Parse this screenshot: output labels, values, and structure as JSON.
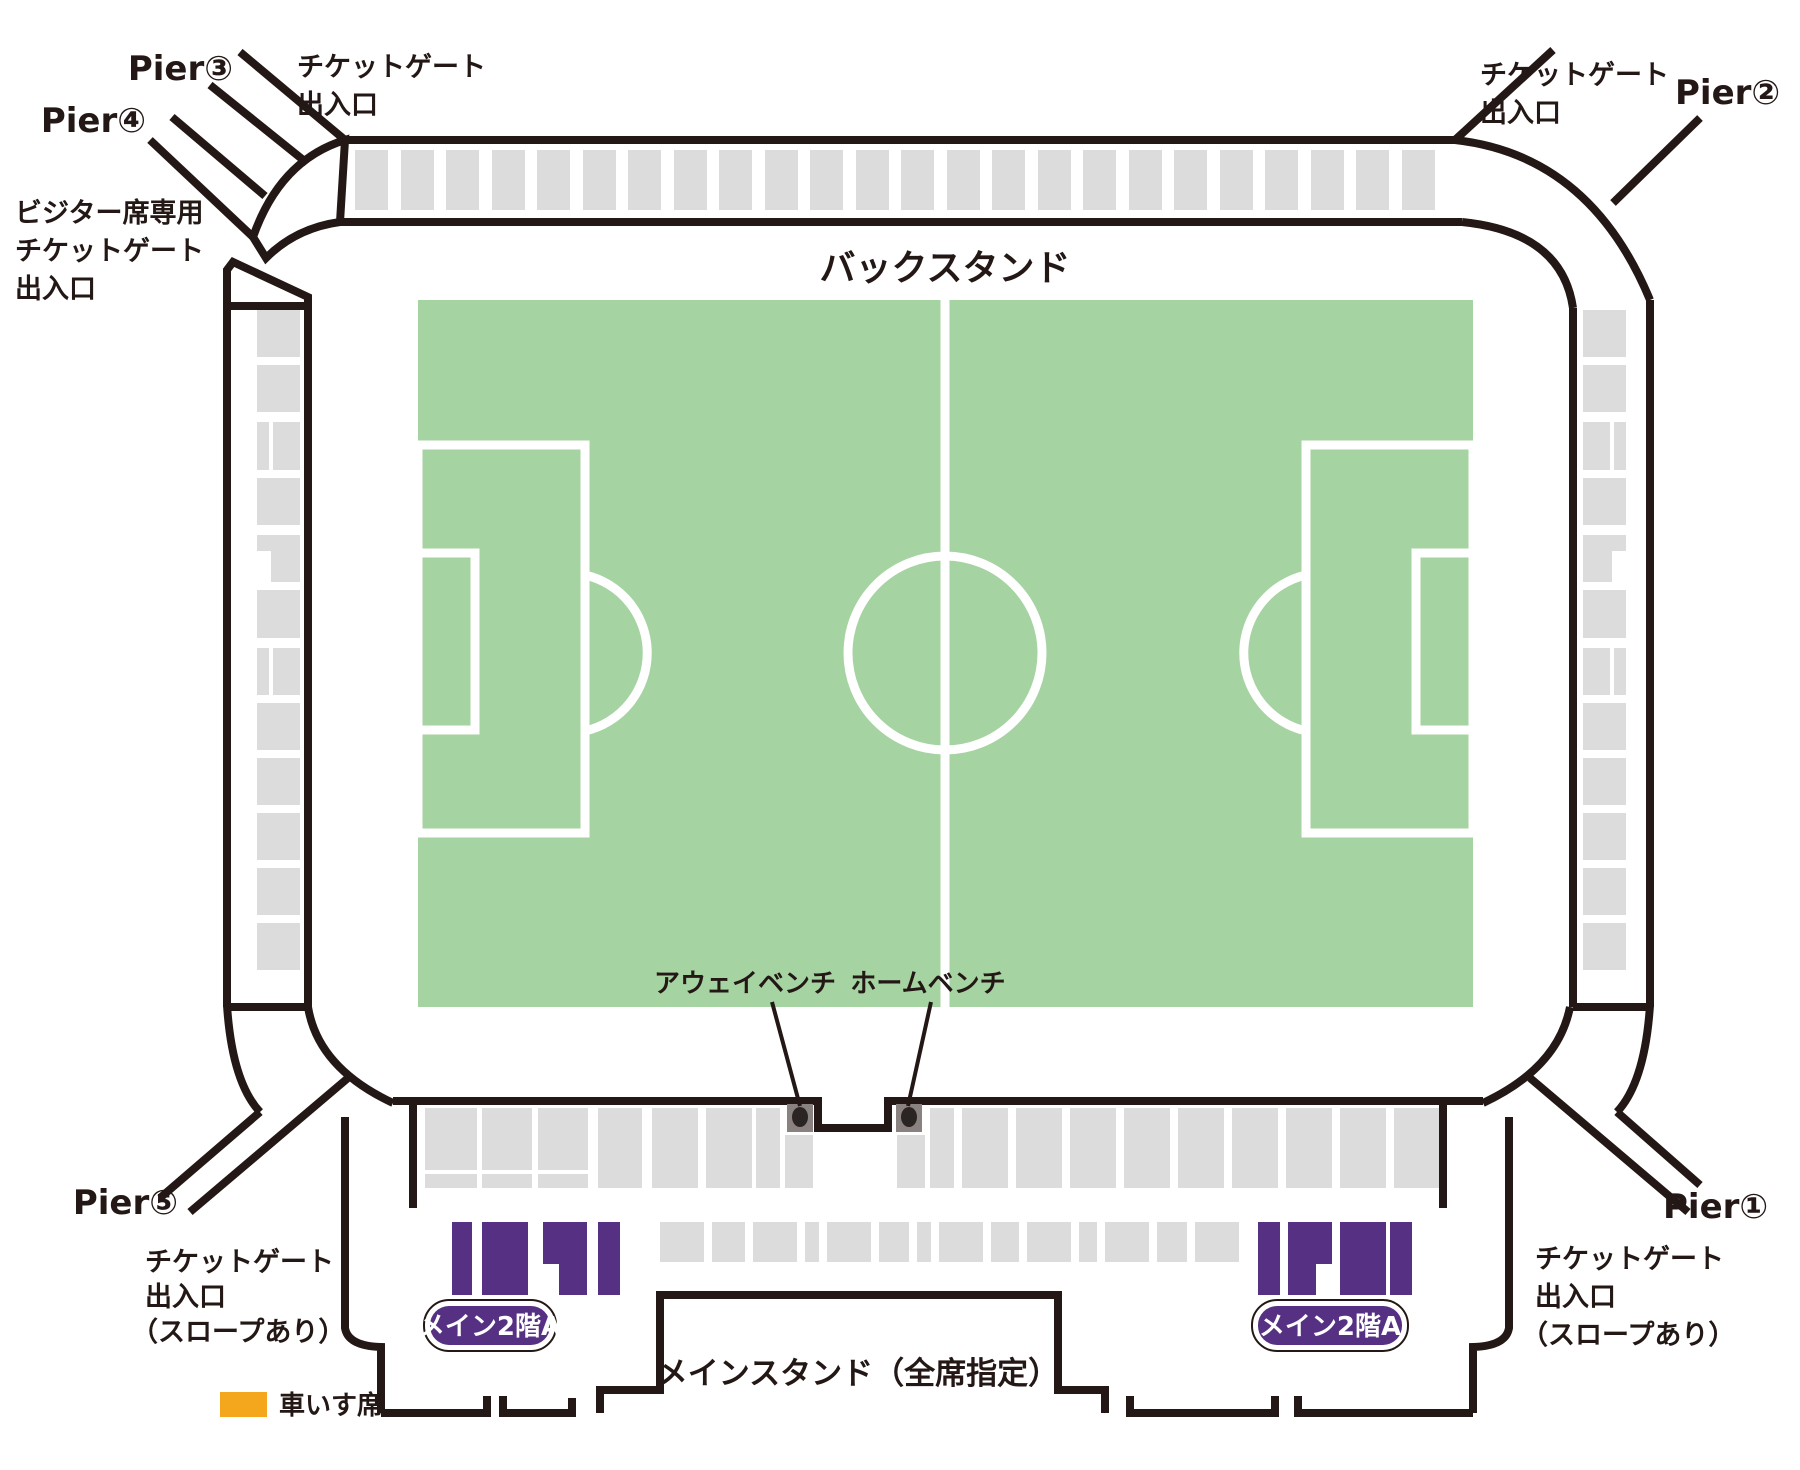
{
  "canvas": {
    "width": 1800,
    "height": 1470
  },
  "colors": {
    "outline": "#231815",
    "seat_gray": "#DCDCDC",
    "pitch_green": "#A6D3A2",
    "purple": "#563082",
    "orange": "#F4A71D",
    "bench_gray": "#8A8280",
    "bench_dot": "#2A2523",
    "white": "#FFFFFF"
  },
  "labels": {
    "pier1": "Pier①",
    "pier2": "Pier②",
    "pier3": "Pier③",
    "pier4": "Pier④",
    "pier5": "Pier⑤",
    "gate_line1": "チケットゲート",
    "gate_line2": "出入口",
    "gate_slope": "（スロープあり）",
    "visitor_line1": "ビジター席専用",
    "visitor_line2": "チケットゲート",
    "visitor_line3": "出入口",
    "back_stand": "バックスタンド",
    "main_stand": "メインスタンド（全席指定）",
    "away_bench": "アウェイベンチ",
    "home_bench": "ホームベンチ",
    "main_2f_badge": "メイン2階A",
    "wheelchair": "車いす席"
  },
  "seat_blocks": {
    "top_band": {
      "name": "back-stand-seat-block",
      "fill": "#DCDCDC",
      "rects": [
        [
          355,
          150,
          33,
          60
        ],
        [
          401,
          150,
          33,
          60
        ],
        [
          446,
          150,
          33,
          60
        ],
        [
          492,
          150,
          33,
          60
        ],
        [
          537,
          150,
          33,
          60
        ],
        [
          583,
          150,
          33,
          60
        ],
        [
          628,
          150,
          33,
          60
        ],
        [
          674,
          150,
          33,
          60
        ],
        [
          719,
          150,
          33,
          60
        ],
        [
          765,
          150,
          33,
          60
        ],
        [
          810,
          150,
          33,
          60
        ],
        [
          856,
          150,
          33,
          60
        ],
        [
          901,
          150,
          33,
          60
        ],
        [
          947,
          150,
          33,
          60
        ],
        [
          992,
          150,
          33,
          60
        ],
        [
          1038,
          150,
          33,
          60
        ],
        [
          1083,
          150,
          33,
          60
        ],
        [
          1129,
          150,
          33,
          60
        ],
        [
          1174,
          150,
          33,
          60
        ],
        [
          1220,
          150,
          33,
          60
        ],
        [
          1265,
          150,
          33,
          60
        ],
        [
          1311,
          150,
          33,
          60
        ],
        [
          1356,
          150,
          33,
          60
        ],
        [
          1402,
          150,
          33,
          60
        ]
      ]
    },
    "left_strip": {
      "name": "west-stand-seat-block",
      "fill": "#DCDCDC",
      "rects": [
        [
          257,
          310,
          43,
          47
        ],
        [
          257,
          365,
          43,
          47
        ],
        [
          257,
          422,
          12,
          48
        ],
        [
          273,
          422,
          27,
          48
        ],
        [
          257,
          478,
          43,
          47
        ],
        [
          257,
          535,
          43,
          47
        ],
        [
          257,
          590,
          43,
          48
        ],
        [
          257,
          648,
          12,
          47
        ],
        [
          273,
          648,
          27,
          47
        ],
        [
          257,
          703,
          43,
          47
        ],
        [
          257,
          758,
          43,
          47
        ],
        [
          257,
          813,
          43,
          47
        ],
        [
          257,
          868,
          43,
          47
        ],
        [
          257,
          923,
          43,
          47
        ]
      ]
    },
    "left_strip_notch": {
      "name": "seat-block-notch",
      "fill": "#FFFFFF",
      "rects": [
        [
          257,
          551,
          14,
          31
        ]
      ]
    },
    "right_strip": {
      "name": "east-stand-seat-block",
      "fill": "#DCDCDC",
      "rects": [
        [
          1583,
          310,
          43,
          47
        ],
        [
          1583,
          365,
          43,
          47
        ],
        [
          1583,
          422,
          27,
          48
        ],
        [
          1614,
          422,
          12,
          48
        ],
        [
          1583,
          478,
          43,
          47
        ],
        [
          1583,
          535,
          43,
          47
        ],
        [
          1583,
          590,
          43,
          48
        ],
        [
          1583,
          648,
          27,
          47
        ],
        [
          1614,
          648,
          12,
          47
        ],
        [
          1583,
          703,
          43,
          47
        ],
        [
          1583,
          758,
          43,
          47
        ],
        [
          1583,
          813,
          43,
          47
        ],
        [
          1583,
          868,
          43,
          47
        ],
        [
          1583,
          923,
          43,
          47
        ]
      ]
    },
    "right_strip_notch": {
      "name": "seat-block-notch",
      "fill": "#FFFFFF",
      "rects": [
        [
          1612,
          551,
          14,
          31
        ]
      ]
    },
    "main_tier1": {
      "name": "main-stand-seat-block",
      "fill": "#DCDCDC",
      "rects": [
        [
          425,
          1108,
          52,
          62
        ],
        [
          425,
          1174,
          52,
          14
        ],
        [
          482,
          1108,
          50,
          62
        ],
        [
          482,
          1174,
          50,
          14
        ],
        [
          538,
          1108,
          50,
          62
        ],
        [
          538,
          1174,
          50,
          14
        ],
        [
          598,
          1108,
          44,
          80
        ],
        [
          652,
          1108,
          46,
          80
        ],
        [
          706,
          1108,
          46,
          80
        ],
        [
          756,
          1108,
          24,
          80
        ],
        [
          785,
          1135,
          28,
          53
        ],
        [
          897,
          1135,
          28,
          53
        ],
        [
          930,
          1108,
          24,
          80
        ],
        [
          962,
          1108,
          46,
          80
        ],
        [
          1016,
          1108,
          46,
          80
        ],
        [
          1070,
          1108,
          46,
          80
        ],
        [
          1124,
          1108,
          46,
          80
        ],
        [
          1178,
          1108,
          46,
          80
        ],
        [
          1232,
          1108,
          46,
          80
        ],
        [
          1286,
          1108,
          46,
          80
        ],
        [
          1340,
          1108,
          46,
          80
        ],
        [
          1394,
          1108,
          46,
          80
        ]
      ]
    },
    "main_tier2": {
      "name": "main-stand-seat-block",
      "fill": "#DCDCDC",
      "rects": [
        [
          660,
          1222,
          44,
          40
        ],
        [
          712,
          1222,
          33,
          40
        ],
        [
          753,
          1222,
          44,
          40
        ],
        [
          805,
          1222,
          14,
          40
        ],
        [
          827,
          1222,
          44,
          40
        ],
        [
          879,
          1222,
          30,
          40
        ],
        [
          917,
          1222,
          14,
          40
        ],
        [
          939,
          1222,
          44,
          40
        ],
        [
          991,
          1222,
          28,
          40
        ],
        [
          1027,
          1222,
          44,
          40
        ],
        [
          1079,
          1222,
          18,
          40
        ],
        [
          1105,
          1222,
          44,
          40
        ],
        [
          1157,
          1222,
          30,
          40
        ],
        [
          1195,
          1222,
          44,
          40
        ]
      ]
    },
    "purple_left": {
      "name": "main-2f-a-seat-block",
      "fill": "#563082",
      "rects": [
        [
          452,
          1222,
          20,
          73
        ],
        [
          482,
          1222,
          46,
          73
        ],
        [
          543,
          1222,
          44,
          42
        ],
        [
          559,
          1264,
          28,
          31
        ],
        [
          598,
          1222,
          22,
          73
        ]
      ]
    },
    "purple_right": {
      "name": "main-2f-a-seat-block",
      "fill": "#563082",
      "rects": [
        [
          1258,
          1222,
          22,
          73
        ],
        [
          1288,
          1222,
          44,
          42
        ],
        [
          1288,
          1264,
          28,
          31
        ],
        [
          1340,
          1222,
          46,
          73
        ],
        [
          1390,
          1222,
          22,
          73
        ]
      ]
    }
  }
}
